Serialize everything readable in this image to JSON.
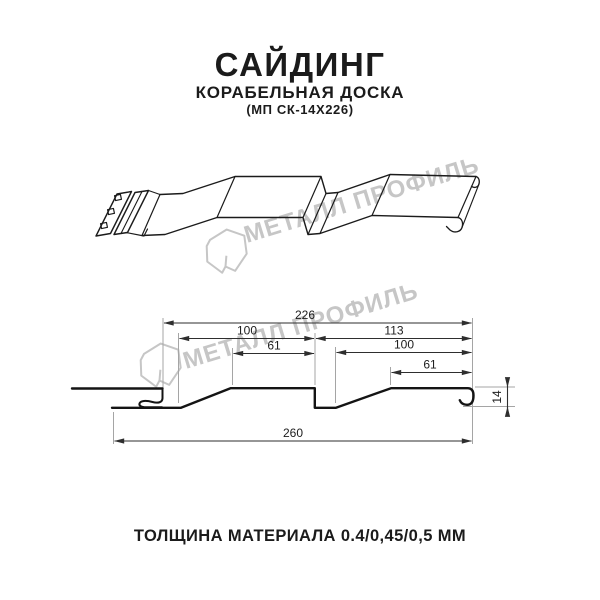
{
  "header": {
    "title": "САЙДИНГ",
    "subtitle": "КОРАБЕЛЬНАЯ ДОСКА",
    "model_code": "(МП СК-14Х226)"
  },
  "watermark": {
    "brand_text": "МЕТАЛЛ ПРОФИЛЬ",
    "logo_icon": "metall-profil-crystal-logo",
    "color": "#c6c6c6"
  },
  "section": {
    "dimensions": {
      "top_overall": "226",
      "left_pitch": "100",
      "left_crest": "61",
      "right_span": "113",
      "right_pitch": "100",
      "right_crest": "61",
      "bottom_overall": "260",
      "profile_height": "14"
    }
  },
  "footer": {
    "thickness_text": "ТОЛЩИНА МАТЕРИАЛА 0.4/0,45/0,5 ММ"
  },
  "colors": {
    "line": "#1b1b1b",
    "dimension": "#2e2e2e",
    "extension": "#a5a5a5",
    "watermark": "#c6c6c6",
    "background": "#ffffff"
  }
}
